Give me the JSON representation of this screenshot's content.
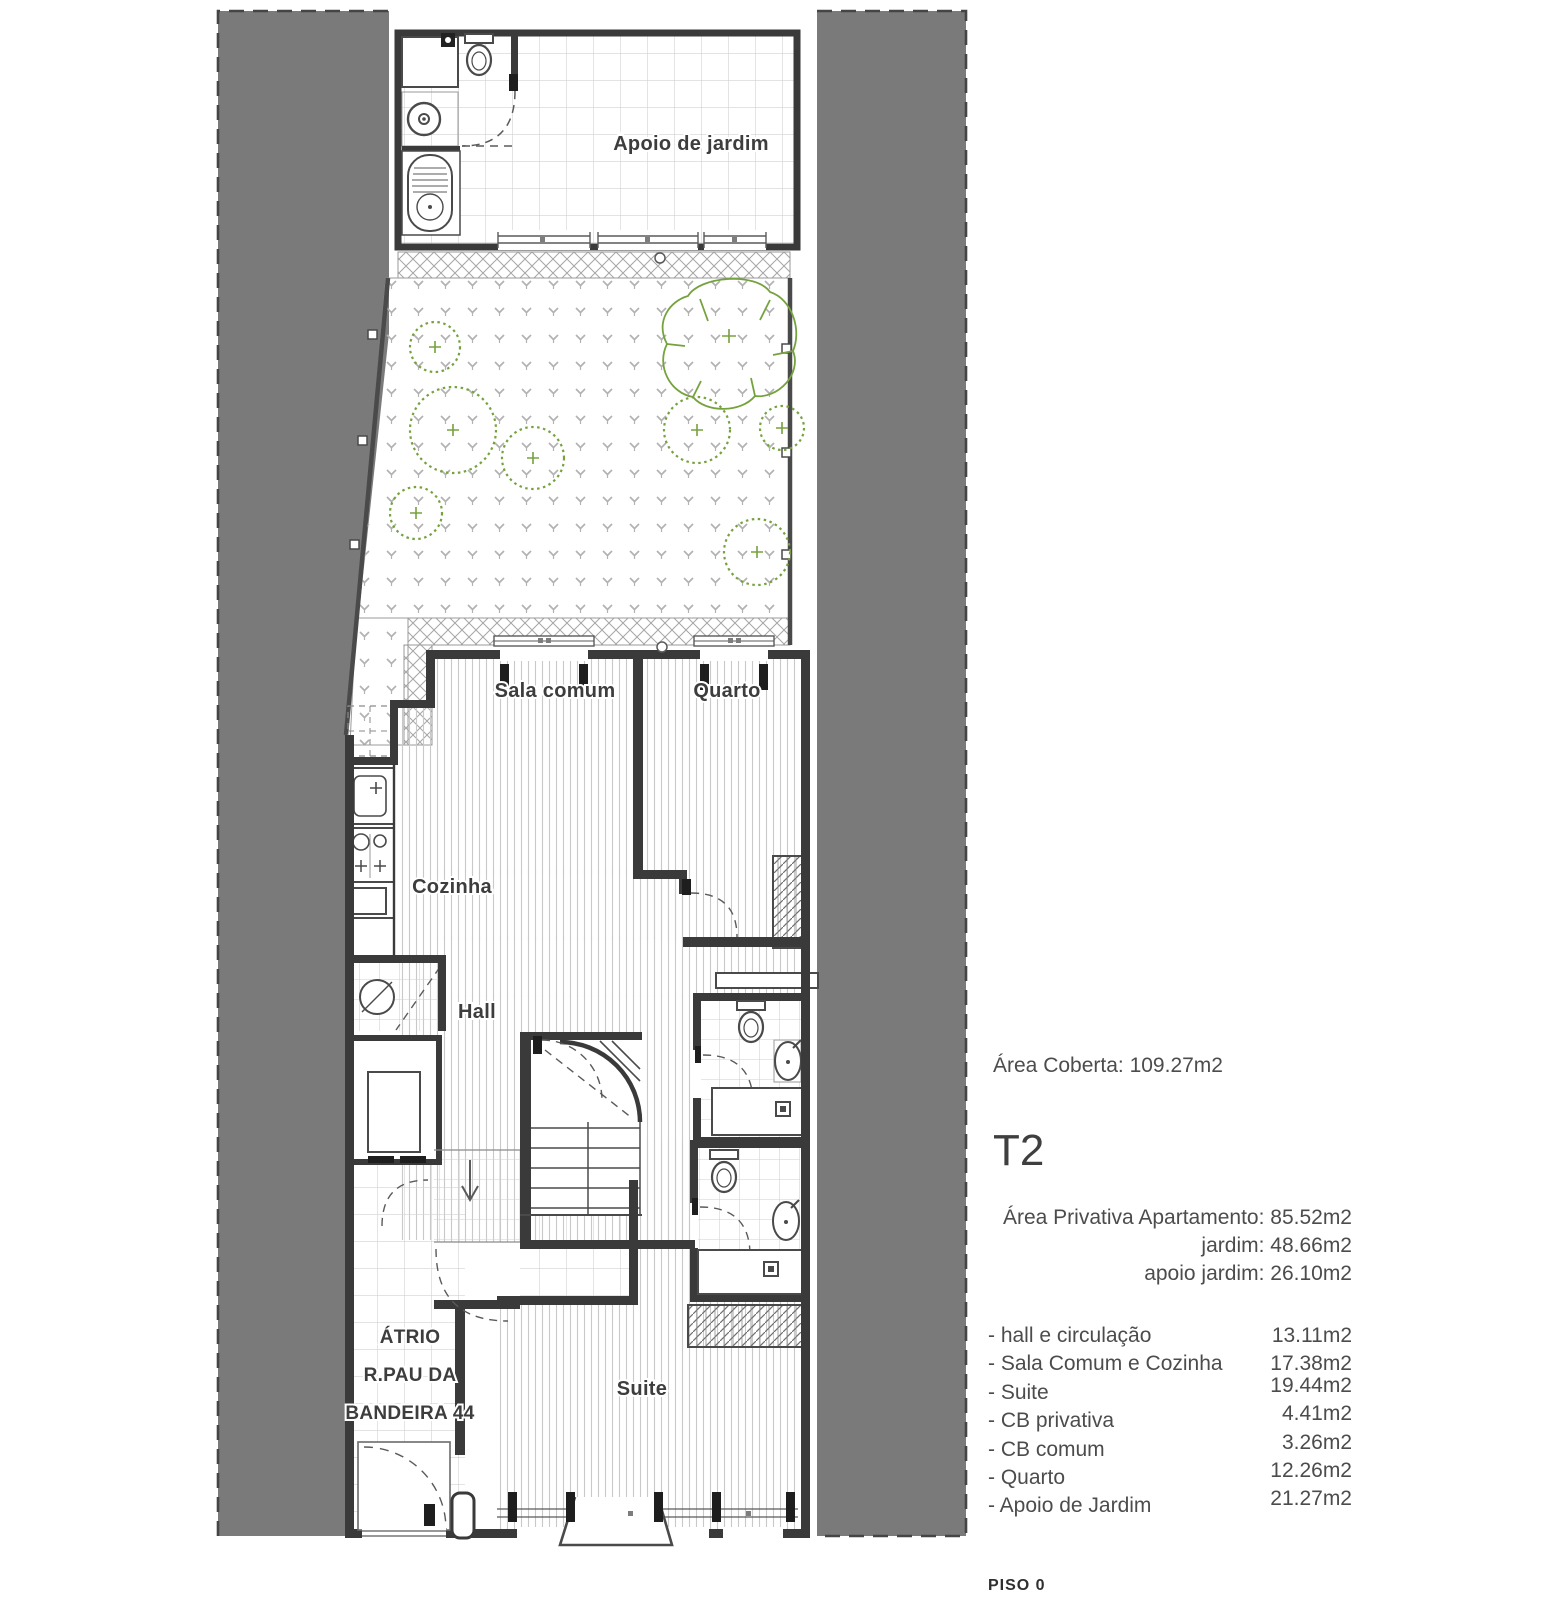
{
  "plan": {
    "labels": {
      "apoio": "Apoio de jardim",
      "sala": "Sala comum",
      "quarto": "Quarto",
      "cozinha": "Cozinha",
      "hall": "Hall",
      "suite": "Suite",
      "atrio_line1": "ÁTRIO",
      "atrio_line2": "R.PAU DA",
      "atrio_line3": "BANDEIRA 44"
    },
    "floor_label": "PISO 0",
    "colors": {
      "site_gray": "#7a7a7a",
      "wall": "#3a3a3a",
      "vegetation_green": "#76a23e"
    }
  },
  "info": {
    "area_coberta": "Área Coberta: 109.27m2",
    "typology": "T2",
    "private_areas": [
      "Área Privativa Apartamento: 85.52m2",
      "jardim: 48.66m2",
      "apoio jardim: 26.10m2"
    ],
    "room_areas": [
      {
        "label": "- hall e circulação",
        "value": "13.11m2"
      },
      {
        "label": "- Sala Comum e Cozinha",
        "value": "17.38m2"
      },
      {
        "label": "- Suite",
        "value": "19.44m2"
      },
      {
        "label": "- CB privativa",
        "value": "4.41m2"
      },
      {
        "label": "- CB comum",
        "value": "3.26m2"
      },
      {
        "label": "- Quarto",
        "value": "12.26m2"
      },
      {
        "label": "- Apoio de Jardim",
        "value": "21.27m2"
      }
    ]
  }
}
